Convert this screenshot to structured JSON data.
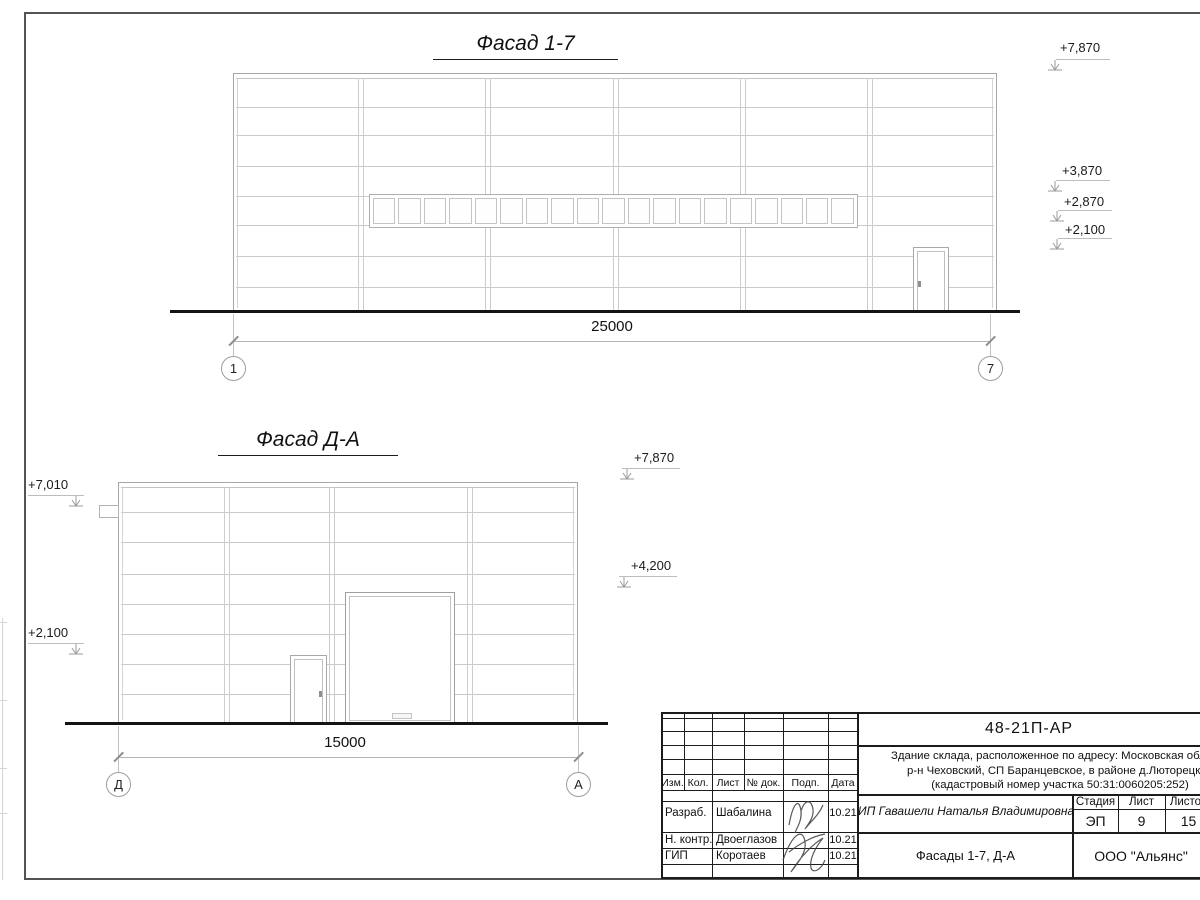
{
  "facade1": {
    "title": "Фасад 1-7",
    "dimension": "25000",
    "grid_left": "1",
    "grid_right": "7",
    "window_panes": 19,
    "elev_7870": "+7,870",
    "elev_3870": "+3,870",
    "elev_2870": "+2,870",
    "elev_2100": "+2,100"
  },
  "facade2": {
    "title": "Фасад Д-А",
    "dimension": "15000",
    "grid_left": "Д",
    "grid_right": "А",
    "elev_left_7010": "+7,010",
    "elev_left_2100": "+2,100",
    "elev_right_7870": "+7,870",
    "elev_right_4200": "+4,200"
  },
  "title_block": {
    "doc_number": "48-21П-АР",
    "address_line1": "Здание склада, расположенное по адресу: Московская область",
    "address_line2": "р-н Чеховский, СП Баранцевское, в районе д.Люторецкое",
    "address_line3": "(кадастровый номер участка 50:31:0060205:252)",
    "cols": [
      "Изм.",
      "Кол.",
      "Лист",
      "№ док.",
      "Подп.",
      "Дата"
    ],
    "rows": [
      {
        "role": "Разраб.",
        "name": "Шабалина",
        "date": "10.21"
      },
      {
        "role": "Н. контр.",
        "name": "Двоеглазов",
        "date": "10.21"
      },
      {
        "role": "ГИП",
        "name": "Коротаев",
        "date": "10.21"
      }
    ],
    "client": "ИП Гавашели Наталья Владимировна",
    "stage_label": "Стадия",
    "sheet_label": "Лист",
    "sheets_label": "Листов",
    "stage_value": "ЭП",
    "sheet_value": "9",
    "sheets_value": "15",
    "drawing_title": "Фасады 1-7, Д-А",
    "company": "ООО \"Альянс\""
  }
}
